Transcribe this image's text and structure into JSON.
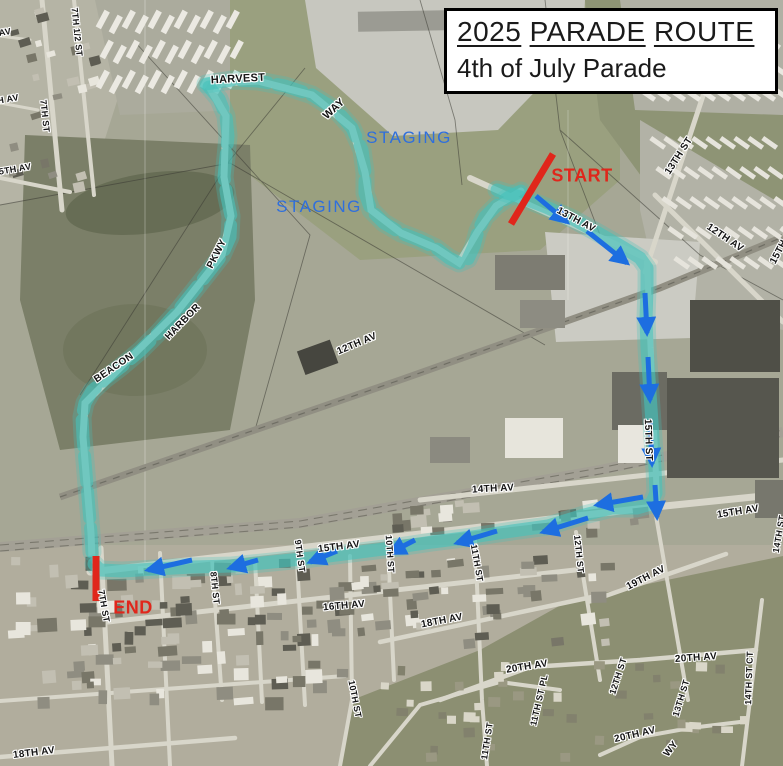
{
  "title": {
    "year": "2025",
    "word2": "PARADE",
    "word3": "ROUTE",
    "subtitle": "4th of July Parade"
  },
  "colors": {
    "route_teal": "#46c1bb",
    "arrow_blue": "#1d6ee0",
    "marker_red": "#e0261b",
    "staging_blue": "#2f6fdd",
    "label_ink": "#141414"
  },
  "staging_labels": [
    {
      "text": "STAGING",
      "x": 409,
      "y": 138
    },
    {
      "text": "STAGING",
      "x": 319,
      "y": 207
    }
  ],
  "markers": {
    "start": {
      "label": "START",
      "text_x": 582,
      "text_y": 176,
      "line": [
        553,
        154,
        511,
        224
      ]
    },
    "end": {
      "label": "END",
      "text_x": 133,
      "text_y": 608,
      "line": [
        96,
        556,
        96,
        601
      ]
    }
  },
  "street_labels": [
    {
      "text": "7TH 1/2 ST",
      "x": 77,
      "y": 32,
      "rot": 84,
      "size": 9
    },
    {
      "text": "7TH ST",
      "x": 45,
      "y": 116,
      "rot": 84,
      "size": 9
    },
    {
      "text": "AV",
      "x": 5,
      "y": 32,
      "rot": -10,
      "size": 9
    },
    {
      "text": "H AV",
      "x": 8,
      "y": 99,
      "rot": -10,
      "size": 9
    },
    {
      "text": "5TH AV",
      "x": 15,
      "y": 169,
      "rot": -10,
      "size": 9
    },
    {
      "text": "HARVEST",
      "x": 238,
      "y": 79,
      "rot": -3,
      "size": 11
    },
    {
      "text": "WAY",
      "x": 334,
      "y": 109,
      "rot": -42,
      "size": 11
    },
    {
      "text": "13TH AV",
      "x": 576,
      "y": 220,
      "rot": 28,
      "size": 10
    },
    {
      "text": "13TH ST",
      "x": 679,
      "y": 156,
      "rot": -57,
      "size": 10
    },
    {
      "text": "12TH AV",
      "x": 725,
      "y": 238,
      "rot": 34,
      "size": 10
    },
    {
      "text": "15TH",
      "x": 779,
      "y": 252,
      "rot": -62,
      "size": 10
    },
    {
      "text": "12TH AV",
      "x": 357,
      "y": 344,
      "rot": -23,
      "size": 10
    },
    {
      "text": "BEACON",
      "x": 114,
      "y": 368,
      "rot": -34,
      "size": 10
    },
    {
      "text": "HARBOR",
      "x": 183,
      "y": 322,
      "rot": -46,
      "size": 10
    },
    {
      "text": "PKWY",
      "x": 217,
      "y": 254,
      "rot": -63,
      "size": 10
    },
    {
      "text": "15TH ST",
      "x": 648,
      "y": 440,
      "rot": 88,
      "size": 10
    },
    {
      "text": "14TH AV",
      "x": 493,
      "y": 489,
      "rot": -3,
      "size": 10
    },
    {
      "text": "15TH AV",
      "x": 738,
      "y": 512,
      "rot": -9,
      "size": 10
    },
    {
      "text": "14TH ST",
      "x": 779,
      "y": 534,
      "rot": -80,
      "size": 9
    },
    {
      "text": "15TH AV",
      "x": 339,
      "y": 547,
      "rot": -7,
      "size": 10
    },
    {
      "text": "19TH AV",
      "x": 646,
      "y": 578,
      "rot": -27,
      "size": 10
    },
    {
      "text": "12TH ST",
      "x": 579,
      "y": 554,
      "rot": 84,
      "size": 9
    },
    {
      "text": "11TH ST",
      "x": 477,
      "y": 563,
      "rot": 80,
      "size": 9
    },
    {
      "text": "10TH ST",
      "x": 390,
      "y": 554,
      "rot": 86,
      "size": 9
    },
    {
      "text": "9TH ST",
      "x": 300,
      "y": 556,
      "rot": 82,
      "size": 9
    },
    {
      "text": "8TH ST",
      "x": 215,
      "y": 588,
      "rot": 84,
      "size": 9
    },
    {
      "text": "7TH ST",
      "x": 104,
      "y": 606,
      "rot": 80,
      "size": 9
    },
    {
      "text": "16TH AV",
      "x": 344,
      "y": 606,
      "rot": -5,
      "size": 10
    },
    {
      "text": "18TH AV",
      "x": 442,
      "y": 621,
      "rot": -11,
      "size": 10
    },
    {
      "text": "18TH AV",
      "x": 34,
      "y": 753,
      "rot": -7,
      "size": 10
    },
    {
      "text": "20TH AV",
      "x": 527,
      "y": 667,
      "rot": -9,
      "size": 10
    },
    {
      "text": "10TH ST",
      "x": 355,
      "y": 699,
      "rot": 79,
      "size": 9
    },
    {
      "text": "11TH ST PL",
      "x": 539,
      "y": 700,
      "rot": -77,
      "size": 9
    },
    {
      "text": "11TH ST",
      "x": 487,
      "y": 741,
      "rot": -81,
      "size": 9
    },
    {
      "text": "20TH AV",
      "x": 696,
      "y": 658,
      "rot": -4,
      "size": 10
    },
    {
      "text": "14TH ST CT",
      "x": 749,
      "y": 678,
      "rot": -88,
      "size": 9
    },
    {
      "text": "12TH ST",
      "x": 618,
      "y": 676,
      "rot": -72,
      "size": 9
    },
    {
      "text": "13TH ST",
      "x": 681,
      "y": 698,
      "rot": -73,
      "size": 9
    },
    {
      "text": "20TH AV",
      "x": 635,
      "y": 735,
      "rot": -13,
      "size": 10
    },
    {
      "text": "WY",
      "x": 671,
      "y": 749,
      "rot": -52,
      "size": 10
    }
  ],
  "route": {
    "staging_loop_east": [
      [
        206,
        84
      ],
      [
        232,
        80
      ],
      [
        258,
        81
      ],
      [
        285,
        86
      ],
      [
        312,
        95
      ],
      [
        336,
        110
      ],
      [
        352,
        128
      ],
      [
        362,
        150
      ],
      [
        365,
        172
      ],
      [
        365,
        193
      ],
      [
        371,
        210
      ],
      [
        384,
        223
      ],
      [
        401,
        233
      ],
      [
        419,
        240
      ],
      [
        436,
        248
      ],
      [
        449,
        258
      ],
      [
        459,
        263
      ],
      [
        468,
        259
      ],
      [
        474,
        246
      ],
      [
        478,
        231
      ],
      [
        485,
        217
      ],
      [
        496,
        206
      ],
      [
        509,
        197
      ],
      [
        521,
        191
      ]
    ],
    "staging_loop_west": [
      [
        209,
        87
      ],
      [
        219,
        99
      ],
      [
        226,
        116
      ],
      [
        228,
        136
      ],
      [
        226,
        157
      ],
      [
        224,
        177
      ],
      [
        227,
        197
      ],
      [
        231,
        216
      ],
      [
        230,
        237
      ],
      [
        222,
        255
      ],
      [
        208,
        273
      ],
      [
        193,
        292
      ],
      [
        177,
        312
      ],
      [
        159,
        332
      ],
      [
        141,
        350
      ],
      [
        121,
        367
      ],
      [
        104,
        380
      ],
      [
        92,
        391
      ],
      [
        85,
        403
      ],
      [
        82,
        417
      ],
      [
        83,
        437
      ],
      [
        85,
        461
      ],
      [
        87,
        485
      ],
      [
        89,
        509
      ],
      [
        91,
        533
      ],
      [
        92,
        552
      ]
    ],
    "main": [
      [
        497,
        190
      ],
      [
        520,
        197
      ],
      [
        546,
        207
      ],
      [
        573,
        219
      ],
      [
        600,
        234
      ],
      [
        624,
        248
      ],
      [
        640,
        258
      ],
      [
        647,
        268
      ],
      [
        647,
        288
      ],
      [
        646,
        318
      ],
      [
        647,
        348
      ],
      [
        649,
        378
      ],
      [
        651,
        408
      ],
      [
        653,
        438
      ],
      [
        655,
        468
      ],
      [
        656,
        493
      ],
      [
        651,
        504
      ],
      [
        637,
        508
      ],
      [
        612,
        508
      ],
      [
        584,
        515
      ],
      [
        548,
        526
      ],
      [
        512,
        531
      ],
      [
        472,
        537
      ],
      [
        432,
        542
      ],
      [
        392,
        548
      ],
      [
        352,
        553
      ],
      [
        312,
        558
      ],
      [
        272,
        562
      ],
      [
        232,
        566
      ],
      [
        192,
        567
      ],
      [
        156,
        569
      ],
      [
        122,
        571
      ],
      [
        100,
        570
      ],
      [
        94,
        564
      ]
    ]
  },
  "arrows": [
    [
      536,
      196,
      567,
      222
    ],
    [
      587,
      231,
      627,
      263
    ],
    [
      645,
      293,
      647,
      333
    ],
    [
      648,
      357,
      650,
      400
    ],
    [
      650,
      420,
      652,
      464
    ],
    [
      655,
      485,
      657,
      517
    ],
    [
      643,
      497,
      597,
      505
    ],
    [
      588,
      518,
      543,
      532
    ],
    [
      497,
      531,
      457,
      543
    ],
    [
      415,
      540,
      390,
      553
    ],
    [
      337,
      551,
      310,
      562
    ],
    [
      258,
      560,
      230,
      568
    ],
    [
      192,
      560,
      148,
      570
    ]
  ]
}
